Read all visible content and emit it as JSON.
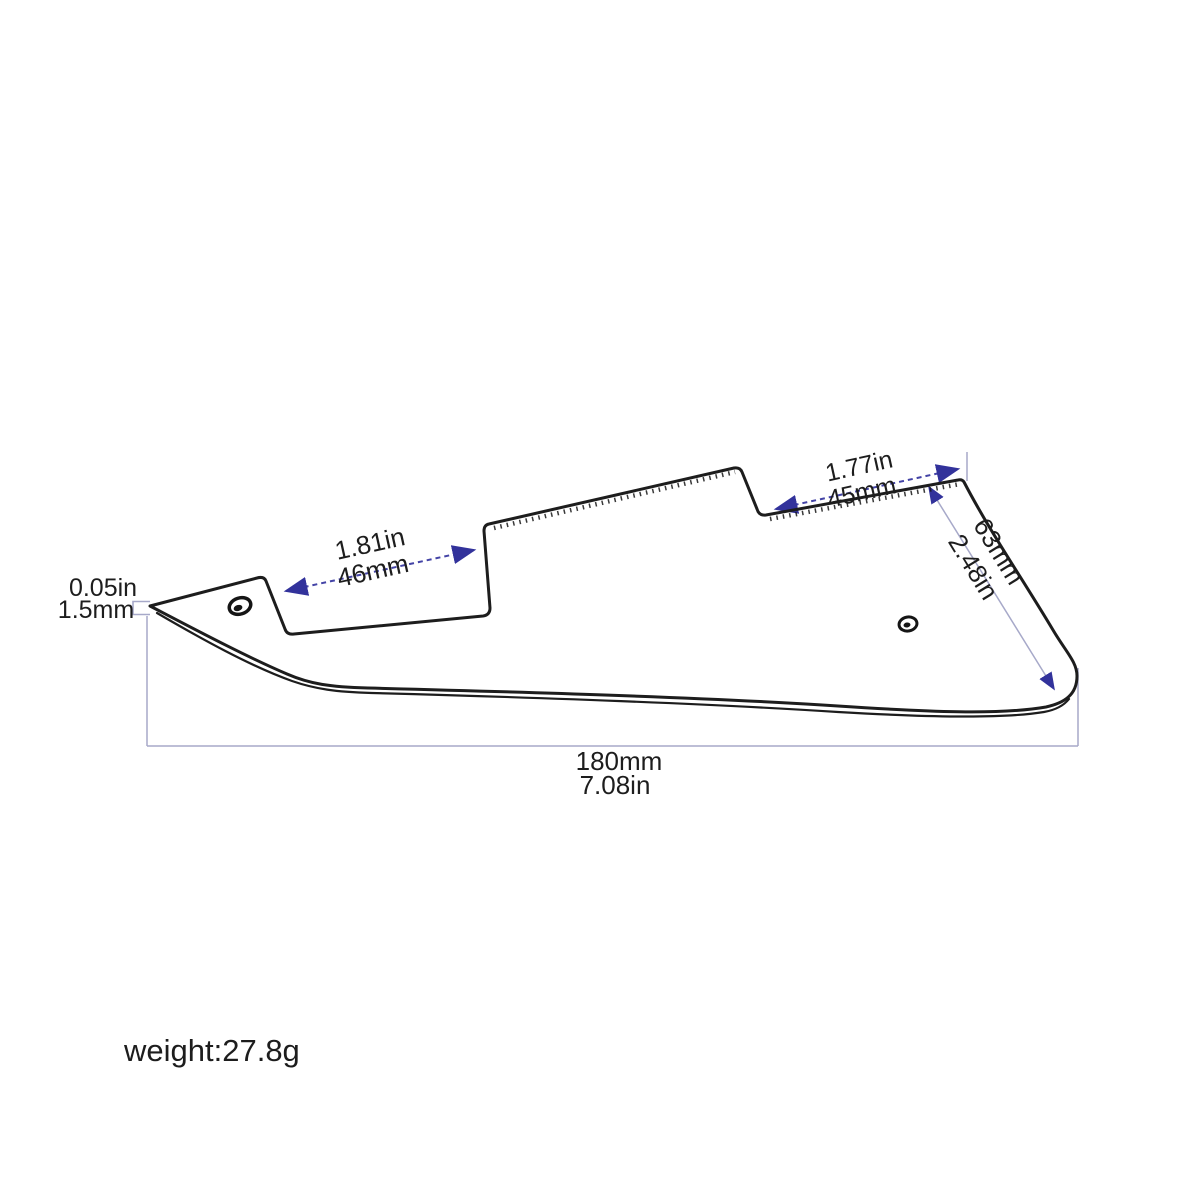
{
  "diagram": {
    "dimensions": {
      "thickness": {
        "line1": "0.05in",
        "line2": "1.5mm"
      },
      "neck_pickup_edge": {
        "line1": "1.81in",
        "line2": "46mm"
      },
      "bridge_pickup_edge": {
        "line1": "1.77in",
        "line2": "45mm"
      },
      "right_edge": {
        "line1": "63mm",
        "line2": "2.48in"
      },
      "overall_length": {
        "line1": "180mm",
        "line2": "7.08in"
      }
    },
    "weight_label": "weight:27.8g",
    "colors": {
      "outline": "#1d1d1d",
      "text": "#1d1d1d",
      "dimension_arrow": "#4040a4",
      "arrowhead": "#32329b",
      "extension_line": "#a7a9c9",
      "background": "#ffffff"
    }
  }
}
